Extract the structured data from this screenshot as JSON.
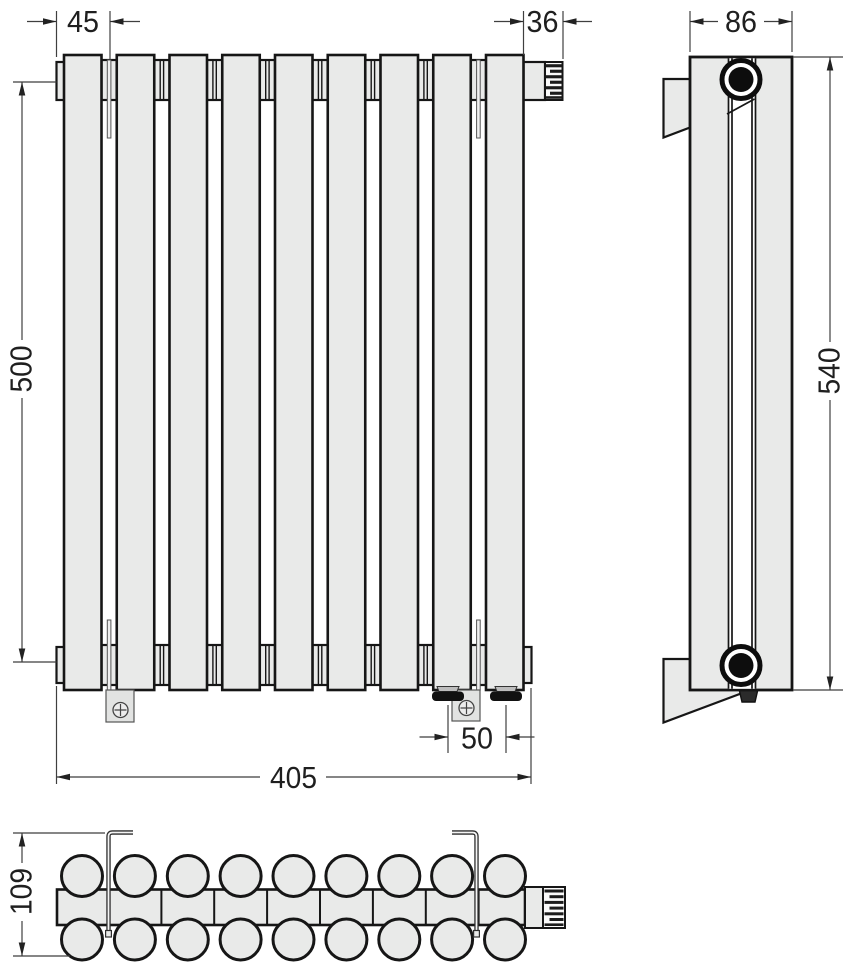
{
  "drawing": {
    "views": {
      "front": {
        "name": "front-view",
        "sections": 9
      },
      "side": {
        "name": "side-view"
      },
      "top": {
        "name": "top-view",
        "tubes_per_row": 9
      }
    },
    "dimensions": {
      "d45": "45",
      "d36": "36",
      "d86": "86",
      "d500": "500",
      "d540": "540",
      "d405": "405",
      "d50": "50",
      "d109": "109"
    },
    "colors": {
      "outline": "#161616",
      "fill": "#e9eae9",
      "dimension_line": "#3f3f3f"
    }
  }
}
